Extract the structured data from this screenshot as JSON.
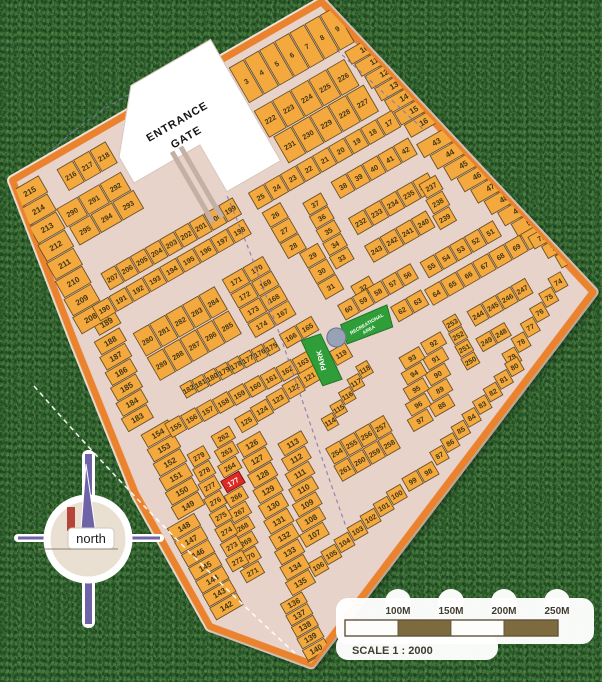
{
  "plan": {
    "entrance": {
      "line1": "ENTRANCE",
      "line2": "GATE"
    },
    "park_label": "PARK",
    "recreation_label_1": "RECREATIONAL",
    "recreation_label_2": "AREA",
    "highlighted_lot": "177",
    "colors": {
      "lot": "#F3A93E",
      "lot_stroke": "#6B5128",
      "road": "#E8D3CA",
      "border": "#EA822F",
      "green": "#2F9E38",
      "green_stroke": "#20742A",
      "red": "#DD2B23",
      "gray_circle": "#98A2B4",
      "text": "#403514",
      "scale_brown": "#7D6B3F"
    },
    "blocks": [
      {
        "x": 244,
        "y": 8,
        "w": 17.5,
        "h": 42,
        "rows": [
          [
            "3",
            "4",
            "5",
            "6",
            "7",
            "8",
            "9"
          ]
        ]
      },
      {
        "x": 352,
        "y": 52,
        "w": 38,
        "h": 15.5,
        "skew": 2.5,
        "rows": [
          [
            "10"
          ],
          [
            "11"
          ],
          [
            "12"
          ],
          [
            "13"
          ],
          [
            "14"
          ],
          [
            "15"
          ],
          [
            "16"
          ]
        ]
      },
      {
        "x": 244,
        "y": 58,
        "w": 21,
        "h": 32,
        "skew": 4,
        "rows": [
          [
            "222",
            "223",
            "224",
            "225",
            "226"
          ],
          [
            "231",
            "230",
            "229",
            "228",
            "227"
          ]
        ]
      },
      {
        "x": 198,
        "y": 126,
        "w": 18.5,
        "h": 20,
        "rows": [
          [
            "25",
            "24",
            "23",
            "22",
            "21",
            "20",
            "19",
            "18",
            "17"
          ]
        ]
      },
      {
        "x": 275,
        "y": 158,
        "w": 18,
        "h": 20,
        "rows": [
          [
            "38",
            "39",
            "40",
            "41",
            "42"
          ]
        ]
      },
      {
        "x": 200,
        "y": 150,
        "w": 22,
        "h": 18,
        "rows": [
          [
            "26"
          ],
          [
            "27"
          ],
          [
            "28"
          ]
        ]
      },
      {
        "x": 212,
        "y": 204,
        "w": 22,
        "h": 18,
        "rows": [
          [
            "29"
          ],
          [
            "30"
          ],
          [
            "31"
          ]
        ]
      },
      {
        "x": 240,
        "y": 162,
        "w": 22,
        "h": 15,
        "skew": -1,
        "rows": [
          [
            "37"
          ],
          [
            "36"
          ],
          [
            "35"
          ],
          [
            "34"
          ],
          [
            "33"
          ]
        ]
      },
      {
        "x": 240,
        "y": 258,
        "w": 22,
        "h": 16,
        "rows": [
          [
            "32"
          ]
        ]
      },
      {
        "x": 368,
        "y": 168,
        "w": 38,
        "h": 16.6,
        "skew": 6,
        "rows": [
          [
            "43"
          ],
          [
            "44"
          ],
          [
            "45"
          ],
          [
            "46"
          ],
          [
            "47"
          ],
          [
            "48"
          ],
          [
            "49"
          ],
          [
            "50"
          ]
        ]
      },
      {
        "x": 272,
        "y": 198,
        "w": 18.5,
        "h": 20,
        "skew": 1,
        "rows": [
          [
            "232",
            "233",
            "234",
            "235",
            "236"
          ]
        ]
      },
      {
        "x": 350,
        "y": 204,
        "w": 20,
        "h": 17,
        "skew": -2,
        "rows": [
          [
            "237"
          ],
          [
            "238"
          ],
          [
            "239"
          ]
        ]
      },
      {
        "x": 272,
        "y": 230,
        "w": 18,
        "h": 20,
        "rows": [
          [
            "243",
            "242",
            "241",
            "240"
          ]
        ]
      },
      {
        "x": 312,
        "y": 272,
        "w": 17,
        "h": 19,
        "rows": [
          [
            "55",
            "54",
            "53",
            "52",
            "51"
          ]
        ]
      },
      {
        "x": 219,
        "y": 268,
        "w": 17,
        "h": 18,
        "rows": [
          [
            "60",
            "59",
            "58",
            "57",
            "56"
          ]
        ]
      },
      {
        "x": 264,
        "y": 296,
        "w": 18,
        "h": 18,
        "rows": [
          [
            "62",
            "63"
          ]
        ]
      },
      {
        "x": 302,
        "y": 298,
        "w": 18.5,
        "h": 19,
        "rows": [
          [
            "64",
            "65",
            "66",
            "67",
            "68",
            "69",
            "70"
          ]
        ]
      },
      {
        "x": 418,
        "y": 304,
        "w": 24,
        "h": 15,
        "skew": 7,
        "rows": [
          [
            "71"
          ],
          [
            "72"
          ],
          [
            "73"
          ]
        ]
      },
      {
        "x": 430,
        "y": 350,
        "w": -15.5,
        "dy": 8.4,
        "h": 17,
        "rows": [
          [
            "74",
            "75",
            "76",
            "77",
            "78",
            "79"
          ]
        ]
      },
      {
        "x": 350,
        "y": 402,
        "w": -15.6,
        "dy": 5.6,
        "h": 16,
        "rows": [
          [
            "80",
            "81",
            "82",
            "83",
            "84",
            "85",
            "86",
            "87"
          ]
        ]
      },
      {
        "x": 272,
        "y": 342,
        "w": 24,
        "h": 14.5,
        "skew": -6,
        "rows": [
          [
            "92"
          ],
          [
            "91"
          ],
          [
            "90"
          ],
          [
            "89"
          ],
          [
            "88"
          ]
        ]
      },
      {
        "x": 246,
        "y": 344,
        "w": 24,
        "h": 14.5,
        "skew": -6,
        "rows": [
          [
            "93"
          ],
          [
            "94"
          ],
          [
            "95"
          ],
          [
            "96"
          ],
          [
            "97"
          ]
        ]
      },
      {
        "x": 188,
        "y": 450,
        "w": 18,
        "h": 16,
        "rows": [
          [
            "99",
            "98"
          ]
        ]
      },
      {
        "x": 185,
        "y": 454,
        "w": -17.3,
        "dy": 3.8,
        "h": 16,
        "rows": [
          [
            "100",
            "101",
            "102",
            "103",
            "104",
            "105",
            "106"
          ]
        ]
      },
      {
        "x": 328,
        "y": 338,
        "w": 17,
        "h": 18,
        "rows": [
          [
            "244",
            "245",
            "246",
            "247"
          ]
        ]
      },
      {
        "x": 302,
        "y": 334,
        "w": 16,
        "h": 14,
        "skew": -1,
        "rows": [
          [
            "253"
          ],
          [
            "252"
          ],
          [
            "251"
          ],
          [
            "250"
          ]
        ]
      },
      {
        "x": 322,
        "y": 366,
        "w": 17,
        "h": 16,
        "rows": [
          [
            "249",
            "248"
          ]
        ]
      },
      {
        "x": 98,
        "y": 358,
        "w": 28,
        "h": 15,
        "skew": -4.5,
        "rows": [
          [
            "113"
          ],
          [
            "112"
          ],
          [
            "111"
          ],
          [
            "110"
          ],
          [
            "109"
          ],
          [
            "108"
          ],
          [
            "107"
          ]
        ]
      },
      {
        "x": 62,
        "y": 338,
        "w": 28,
        "h": 16,
        "skew": -3,
        "rows": [
          [
            "126"
          ],
          [
            "127"
          ],
          [
            "128"
          ],
          [
            "129"
          ],
          [
            "130"
          ],
          [
            "131"
          ],
          [
            "132"
          ],
          [
            "133"
          ],
          [
            "134"
          ],
          [
            "135"
          ]
        ]
      },
      {
        "x": 208,
        "y": 304,
        "w": -19.3,
        "dy": 1.8,
        "h": 17,
        "rows": [
          [
            "119",
            "120",
            "121",
            "122",
            "123",
            "124",
            "125"
          ]
        ]
      },
      {
        "x": 148,
        "y": 358,
        "w": 14,
        "dy": -7,
        "h": 15,
        "rows": [
          [
            "114",
            "115",
            "116",
            "117",
            "118"
          ]
        ]
      },
      {
        "x": 137,
        "y": 386,
        "w": 17,
        "h": 19,
        "skew": -1.5,
        "rows": [
          [
            "254",
            "255",
            "256",
            "257"
          ],
          [
            "261",
            "260",
            "259",
            "258"
          ]
        ]
      },
      {
        "x": 44,
        "y": 318,
        "w": 22,
        "h": 14.6,
        "skew": -4.7,
        "rows": [
          [
            "262"
          ],
          [
            "263"
          ],
          [
            "264"
          ],
          [
            "177*"
          ],
          [
            "266"
          ],
          [
            "267"
          ],
          [
            "268"
          ],
          [
            "269"
          ],
          [
            "270"
          ],
          [
            "271"
          ]
        ]
      },
      {
        "x": 14,
        "y": 322,
        "w": 20,
        "h": 15.7,
        "skew": -2.7,
        "rows": [
          [
            "279"
          ],
          [
            "278"
          ],
          [
            "277"
          ],
          [
            "276"
          ],
          [
            "275"
          ],
          [
            "274"
          ],
          [
            "273"
          ],
          [
            "272"
          ]
        ]
      },
      {
        "x": 20,
        "y": 498,
        "w": 26,
        "h": 12.8,
        "skew": -1,
        "rows": [
          [
            "136"
          ],
          [
            "137"
          ],
          [
            "138"
          ],
          [
            "139"
          ],
          [
            "140"
          ],
          [
            "141"
          ]
        ]
      },
      {
        "x": -40,
        "y": 376,
        "w": 32,
        "h": 15,
        "skew": -0.5,
        "rows": [
          [
            "148"
          ],
          [
            "147"
          ],
          [
            "146"
          ],
          [
            "145"
          ],
          [
            "144"
          ],
          [
            "143"
          ],
          [
            "142"
          ]
        ]
      },
      {
        "x": -16,
        "y": 282,
        "w": 32,
        "h": 15.5,
        "skew": -2,
        "rows": [
          [
            "154"
          ],
          [
            "153"
          ],
          [
            "152"
          ],
          [
            "151"
          ],
          [
            "150"
          ],
          [
            "149"
          ]
        ]
      },
      {
        "x": 10,
        "y": 284,
        "w": 17.8,
        "dy": 1,
        "h": 17,
        "rows": [
          [
            "155",
            "156",
            "157",
            "158",
            "159",
            "160",
            "161",
            "162",
            "163"
          ]
        ]
      },
      {
        "x": 42,
        "y": 259,
        "w": 13.3,
        "dy": 0.7,
        "h": 15,
        "rows": [
          [
            "182",
            "181",
            "180",
            "179",
            "178",
            "177",
            "176",
            "175"
          ]
        ]
      },
      {
        "x": -10,
        "y": 178,
        "w": 30,
        "h": 16,
        "skew": -3,
        "rows": [
          [
            "188"
          ],
          [
            "187"
          ],
          [
            "186"
          ],
          [
            "185"
          ],
          [
            "184"
          ],
          [
            "183"
          ]
        ]
      },
      {
        "x": -2,
        "y": 160,
        "w": 26,
        "h": 16,
        "rows": [
          [
            "189"
          ]
        ]
      },
      {
        "x": -6,
        "y": 6,
        "w": 32,
        "h": 20,
        "skew": -1.5,
        "rows": [
          [
            "215"
          ],
          [
            "214"
          ],
          [
            "213"
          ],
          [
            "212"
          ],
          [
            "211"
          ],
          [
            "210"
          ],
          [
            "209"
          ],
          [
            "208"
          ]
        ]
      },
      {
        "x": 44,
        "y": 10,
        "w": 19,
        "h": 26,
        "rows": [
          [
            "216",
            "217",
            "218"
          ]
        ]
      },
      {
        "x": 24,
        "y": 44,
        "w": 25,
        "h": 22,
        "skew": 2,
        "rows": [
          [
            "290",
            "291",
            "292"
          ],
          [
            "295",
            "294",
            "293"
          ]
        ]
      },
      {
        "x": 30,
        "y": 122,
        "w": 17,
        "h": 20,
        "rows": [
          [
            "207",
            "206",
            "205",
            "204",
            "203",
            "202",
            "201",
            "200",
            "199"
          ]
        ]
      },
      {
        "x": 6,
        "y": 146,
        "w": 19.5,
        "h": 18,
        "skew": 0.5,
        "rows": [
          [
            "190",
            "191",
            "192",
            "193",
            "194",
            "195",
            "196",
            "197",
            "198"
          ]
        ]
      },
      {
        "x": 28,
        "y": 190,
        "w": 19,
        "h": 28,
        "rows": [
          [
            "280",
            "281",
            "282",
            "283",
            "284"
          ],
          [
            "289",
            "288",
            "287",
            "286",
            "285"
          ]
        ]
      },
      {
        "x": 132,
        "y": 188,
        "w": 24,
        "h": 17,
        "rows": [
          [
            "171",
            "170"
          ],
          [
            "172",
            "169"
          ],
          [
            "173",
            "168"
          ],
          [
            "174",
            "167"
          ]
        ]
      },
      {
        "x": 154,
        "y": 264,
        "w": 19,
        "h": 17,
        "rows": [
          [
            "166",
            "165"
          ]
        ]
      }
    ]
  },
  "compass": {
    "label": "north"
  },
  "scale_bar": {
    "ticks": [
      "100M",
      "150M",
      "200M",
      "250M"
    ],
    "caption": "SCALE 1 : 2000"
  }
}
